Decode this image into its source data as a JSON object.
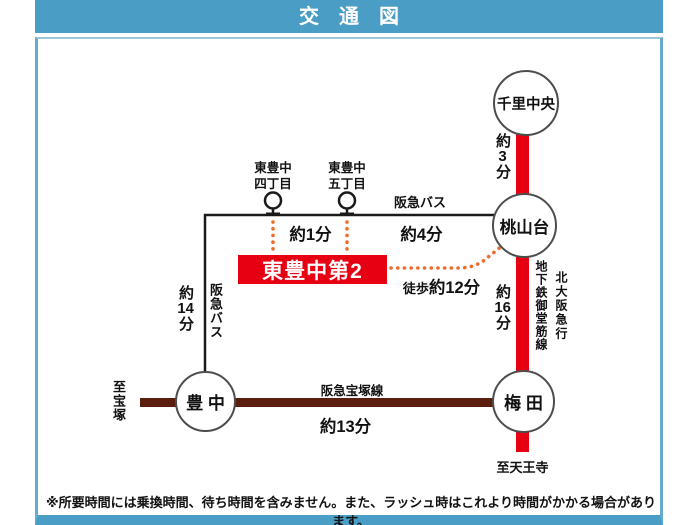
{
  "title": "交　通　図",
  "colors": {
    "header_blue": "#4a9dc4",
    "rail_red": "#e60012",
    "rail_brown": "#5a1d0e",
    "bus_black": "#1a1a1a",
    "walk_dot_orange": "#ed6d2d",
    "property_red": "#e60012"
  },
  "stations": {
    "senri_chuo": "千里中央",
    "momoyamadai": "桃山台",
    "toyonaka": "豊 中",
    "umeda": "梅 田"
  },
  "bus_stops": {
    "yonchome": {
      "line1": "東豊中",
      "line2": "四丁目"
    },
    "gochome": {
      "line1": "東豊中",
      "line2": "五丁目"
    }
  },
  "property": {
    "name": "東豊中第2"
  },
  "lines": {
    "hankyu_bus_top": "阪急バス",
    "hankyu_bus_left": "阪急バス",
    "hankyu_takarazuka": "阪急宝塚線",
    "midosuji": "地下鉄御堂筋線",
    "kita_osaka_kyuko": "北大阪急行"
  },
  "directions": {
    "to_takarazuka": "至宝塚",
    "to_tennoji": "至天王寺"
  },
  "times": {
    "senri_to_momo": {
      "pre": "約",
      "num": "3",
      "suf": "分"
    },
    "stop_to_stop": "約1分",
    "stop_to_momo": "約4分",
    "momo_to_umeda": {
      "pre": "約",
      "num": "16",
      "suf": "分"
    },
    "bus_to_toyonaka": {
      "pre": "約",
      "num": "14",
      "suf": "分"
    },
    "toyonaka_to_umeda": "約13分",
    "walk": {
      "small": "徒歩",
      "big": "約12分"
    }
  },
  "note": "※所要時間には乗換時間、待ち時間を含みません。また、ラッシュ時はこれより時間がかかる場合があります。"
}
